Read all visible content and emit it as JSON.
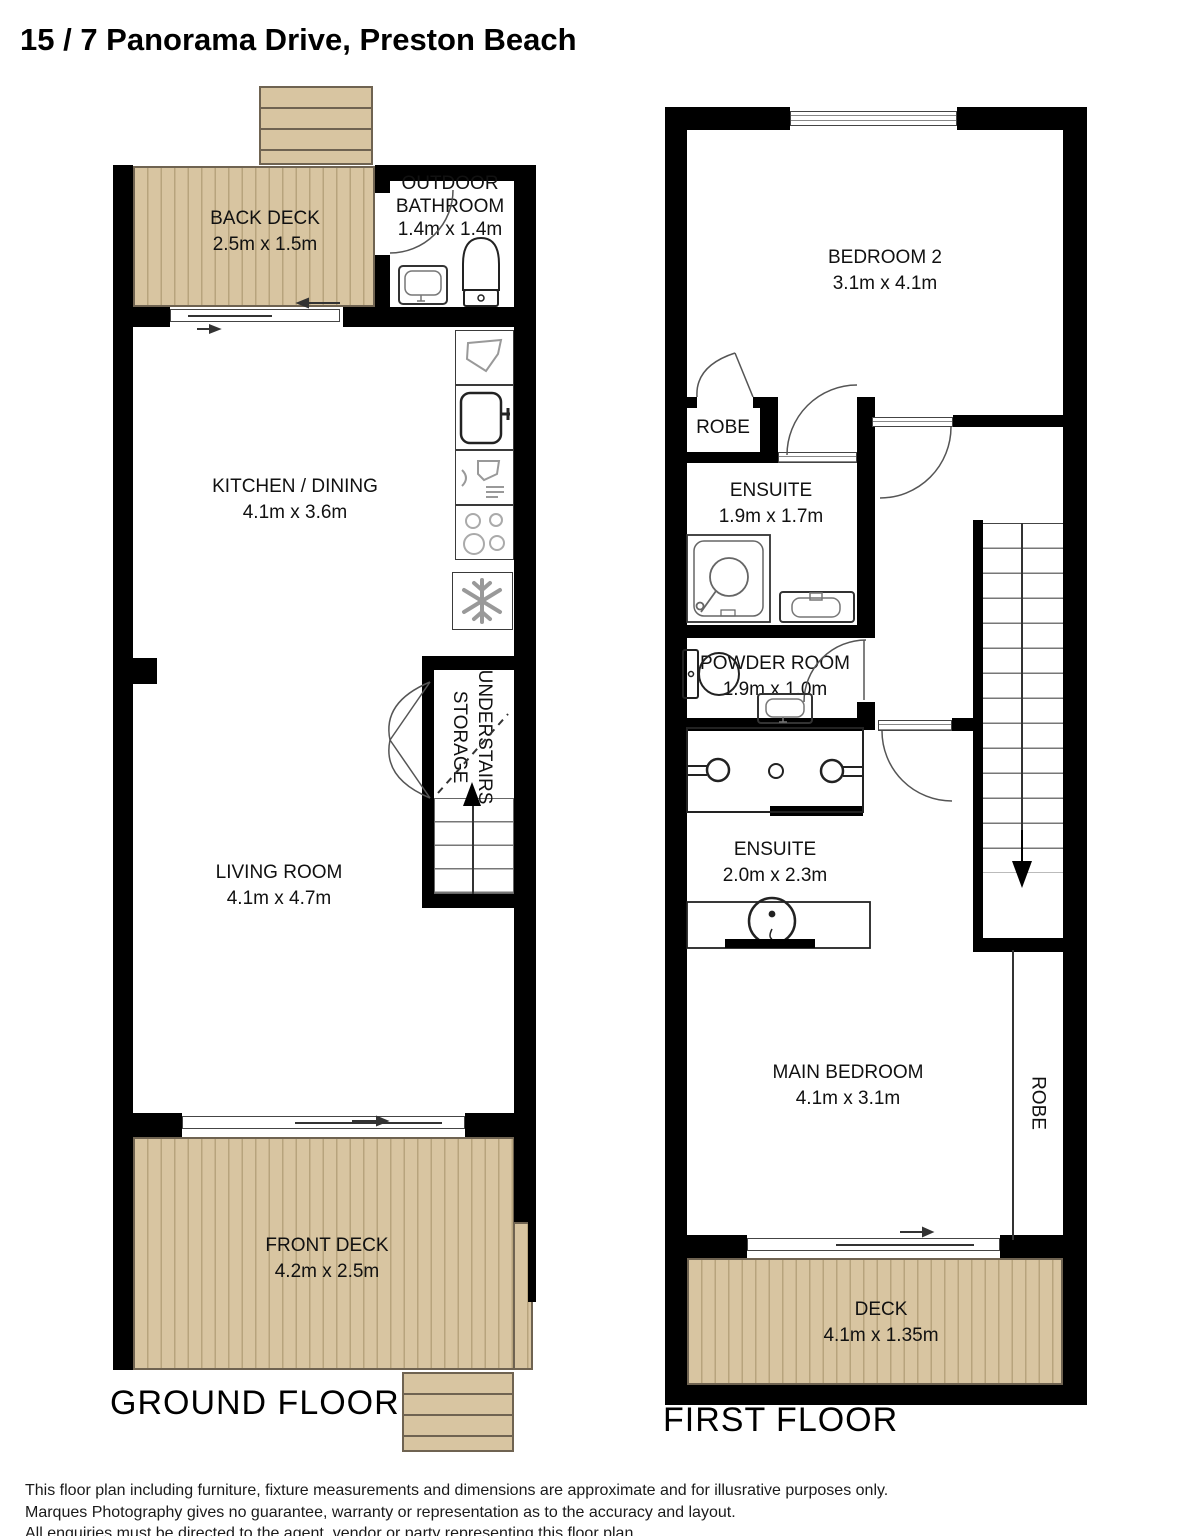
{
  "title": "15 / 7 Panorama Drive, Preston Beach",
  "colors": {
    "deck_fill": "#d8c5a1",
    "deck_stripe": "#b7a47d",
    "wall": "#000000",
    "fixture_gray": "#999999"
  },
  "ground_floor": {
    "label": "GROUND FLOOR",
    "rooms": {
      "back_deck": {
        "name": "BACK DECK",
        "dims": "2.5m x 1.5m"
      },
      "outdoor_bathroom": {
        "line1": "OUTDOOR",
        "line2": "BATHROOM",
        "dims": "1.4m x 1.4m"
      },
      "kitchen_dining": {
        "name": "KITCHEN / DINING",
        "dims": "4.1m x 3.6m"
      },
      "understairs_storage": {
        "line1": "UNDERSTAIRS",
        "line2": "STORAGE"
      },
      "living_room": {
        "name": "LIVING ROOM",
        "dims": "4.1m x 4.7m"
      },
      "front_deck": {
        "name": "FRONT DECK",
        "dims": "4.2m x 2.5m"
      }
    }
  },
  "first_floor": {
    "label": "FIRST FLOOR",
    "rooms": {
      "bedroom2": {
        "name": "BEDROOM 2",
        "dims": "3.1m x 4.1m"
      },
      "robe_bedroom2": {
        "name": "ROBE"
      },
      "ensuite1": {
        "name": "ENSUITE",
        "dims": "1.9m x 1.7m"
      },
      "powder_room": {
        "name": "POWDER ROOM",
        "dims": "1.9m x 1.0m"
      },
      "ensuite2": {
        "name": "ENSUITE",
        "dims": "2.0m x 2.3m"
      },
      "main_bedroom": {
        "name": "MAIN BEDROOM",
        "dims": "4.1m x 3.1m"
      },
      "robe_main": {
        "name": "ROBE"
      },
      "deck": {
        "name": "DECK",
        "dims": "4.1m x 1.35m"
      }
    }
  },
  "disclaimer": {
    "line1": "This floor plan including furniture, fixture measurements and dimensions are approximate and for illusrative purposes only.",
    "line2": "Marques Photography gives no guarantee, warranty or representation as to the accuracy and layout.",
    "line3": "All enquiries must be directed to the agent, vendor or party representing this floor plan."
  }
}
